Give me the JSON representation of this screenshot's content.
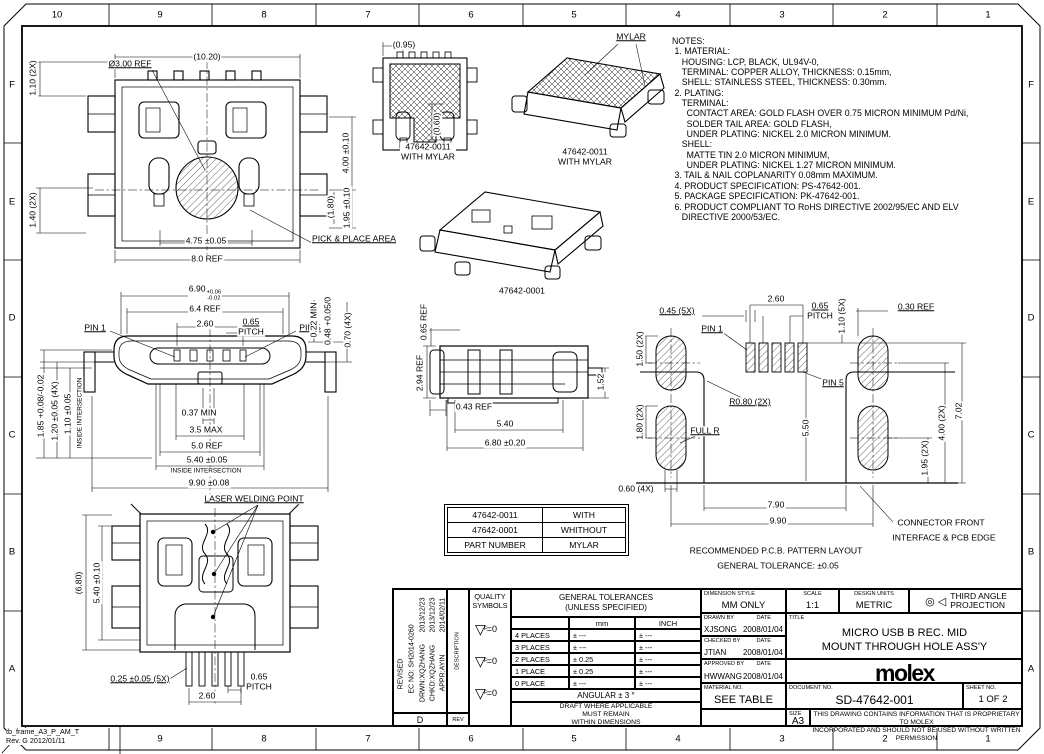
{
  "frame": {
    "cols": [
      "10",
      "9",
      "8",
      "7",
      "6",
      "5",
      "4",
      "3",
      "2",
      "1"
    ],
    "rows": [
      "F",
      "E",
      "D",
      "C",
      "B",
      "A"
    ],
    "stamp": [
      "tb_frame_A3_P_AM_T",
      "Rev. G 2012/01/11"
    ]
  },
  "notes": {
    "lines": [
      "NOTES:",
      " 1. MATERIAL:",
      "    HOUSING: LCP, BLACK, UL94V-0,",
      "    TERMINAL: COPPER ALLOY, THICKNESS: 0.15mm,",
      "    SHELL: STAINLESS STEEL, THICKNESS: 0.30mm.",
      " 2. PLATING:",
      "    TERMINAL:",
      "      CONTACT AREA: GOLD FLASH OVER 0.75 MICRON MINIMUM Pd/Ni,",
      "      SOLDER TAIL AREA: GOLD FLASH,",
      "      UNDER PLATING: NICKEL 2.0 MICRON MINIMUM.",
      "    SHELL:",
      "      MATTE TIN 2.0 MICRON MINIMUM,",
      "      UNDER PLATING: NICKEL 1.27 MICRON MINIMUM.",
      " 3. TAIL & NAIL COPLANARITY 0.08mm MAXIMUM.",
      " 4. PRODUCT SPECIFICATION: PS-47642-001.",
      " 5. PACKAGE SPECIFICATION: PK-47642-001.",
      " 6. PRODUCT COMPLIANT TO RoHS DIRECTIVE 2002/95/EC AND ELV",
      "    DIRECTIVE 2000/53/EC."
    ]
  },
  "views": {
    "top": {
      "d1020": "(10.20)",
      "dia": "Ø3.00 REF",
      "d110": "1.10 (2X)",
      "d140": "1.40 (2X)",
      "d400": "4.00 ±0.10",
      "d180": "(1.80)",
      "d195": "1.95 ±0.10",
      "d475": "4.75 ±0.05",
      "d80": "8.0 REF",
      "pick": "PICK & PLACE AREA"
    },
    "mylar_front": {
      "d095": "(0.95)",
      "d060": "(0.60)",
      "caption": [
        "47642-0011",
        "WITH MYLAR"
      ]
    },
    "iso_mylar": {
      "label": "MYLAR",
      "caption": [
        "47642-0011",
        "WITH MYLAR"
      ]
    },
    "iso_plain": {
      "caption": "47642-0001"
    },
    "front": {
      "d690": {
        "v": "6.90",
        "up": "+0.06",
        "dn": "-0.02"
      },
      "d64": "6.4 REF",
      "d260": "2.60",
      "d065": "0.65",
      "pitch": "PITCH",
      "pin1": "PIN 1",
      "pin5": "PIN 5",
      "d022": "0.22 MIN",
      "d048": "0.48 +0.05/0",
      "d070": "0.70 (4X)",
      "d037": "0.37 MIN",
      "d35": "3.5 MAX",
      "d50": "5.0 REF",
      "d540": "5.40 ±0.05",
      "inside1": "INSIDE INTERSECTION",
      "d990": "9.90 ±0.08",
      "d185": "1.85 +0.08/-0.02",
      "d120": "1.20 ±0.05 (4X)",
      "d110": "1.10 ±0.05",
      "inside2": "INSIDE INTERSECTION"
    },
    "side": {
      "d065": "0.65 REF",
      "d294": "2.94 REF",
      "d043": "0.43 REF",
      "d540": "5.40",
      "d680": "6.80 ±0.20",
      "d152": "1.52"
    },
    "pcb": {
      "d260": "2.60",
      "d045": "0.45 (5X)",
      "d065": "0.65",
      "pitch": "PITCH",
      "d110": "1.10 (5X)",
      "d030": "0.30 REF",
      "d150": "1.50 (2X)",
      "d180": "1.80 (2X)",
      "pin1": "PIN 1",
      "pin5": "PIN 5",
      "r080": "R0.80 (2X)",
      "fullr": "FULL R",
      "d550": "5.50",
      "d060": "0.60 (4X)",
      "d790": "7.90",
      "d990": "9.90",
      "d195": "1.95 (2X)",
      "d400": "4.00 (2X)",
      "d702": "7.02",
      "cf1": "CONNECTOR FRONT",
      "cf2": "INTERFACE & PCB EDGE",
      "t1": "RECOMMENDED P.C.B. PATTERN LAYOUT",
      "t2": "GENERAL TOLERANCE: ±0.05"
    },
    "bottom": {
      "laser": "LASER WELDING POINT",
      "d680": "(6.80)",
      "d540": "5.40 ±0.10",
      "d025": "0.25 ±0.05 (5X)",
      "d065": "0.65",
      "pitch": "PITCH",
      "d260": "2.60"
    }
  },
  "part_table": {
    "rows": [
      [
        "47642-0011",
        "WITH"
      ],
      [
        "47642-0001",
        "WHITHOUT"
      ],
      [
        "PART NUMBER",
        "MYLAR"
      ]
    ]
  },
  "title_block": {
    "revision": {
      "revised": "REVISED",
      "ec": "EC NO: SH2014-0260",
      "drwn": "DRWN:XQZHANG",
      "chkd": "CHKD:XQZHANG",
      "appr": "APPR:AYIN",
      "dates": [
        "2013/12/23",
        "2013/12/23",
        "2014/02/11"
      ],
      "rev_value": "D",
      "rev_label": "REV",
      "description_label": "DESCRIPTION"
    },
    "quality": {
      "header": [
        "QUALITY",
        "SYMBOLS"
      ],
      "symbols": [
        {
          "letter": "F",
          "value": "=0"
        },
        {
          "letter": "F",
          "value": "=0"
        },
        {
          "letter": "F",
          "value": "=0"
        }
      ]
    },
    "tolerances": {
      "title": [
        "GENERAL TOLERANCES",
        "(UNLESS SPECIFIED)"
      ],
      "col_mm": "mm",
      "col_inch": "INCH",
      "rows": [
        [
          "4 PLACES",
          "± ---",
          "± ---"
        ],
        [
          "3 PLACES",
          "± ---",
          "± ---"
        ],
        [
          "2 PLACES",
          "± 0.25",
          "± ---"
        ],
        [
          "1 PLACE",
          "± 0.25",
          "± ---"
        ],
        [
          "0 PLACE",
          "± ---",
          "± ---"
        ]
      ],
      "angular": "ANGULAR ± 3 °",
      "draft": [
        "DRAFT WHERE APPLICABLE",
        "MUST REMAIN",
        "WITHIN DIMENSIONS"
      ]
    },
    "dimension_style": {
      "label": "DIMENSION STYLE",
      "value": "MM ONLY"
    },
    "scale": {
      "label": "SCALE",
      "value": "1:1"
    },
    "design_units": {
      "label": "DESIGN UNITS",
      "value": "METRIC"
    },
    "projection": {
      "symbols": "◎ ◁",
      "label": [
        "THIRD ANGLE",
        "PROJECTION"
      ]
    },
    "drawn": {
      "label": "DRAWN BY",
      "date_label": "DATE",
      "name": "XJSONG",
      "date": "2008/01/04"
    },
    "checked": {
      "label": "CHECKED BY",
      "date_label": "DATE",
      "name": "JTIAN",
      "date": "2008/01/04"
    },
    "approved": {
      "label": "APPROVED BY",
      "date_label": "DATE",
      "name": "HWWANG",
      "date": "2008/01/04"
    },
    "title": {
      "label": "TITLE",
      "lines": [
        "MICRO USB B REC. MID",
        "MOUNT THROUGH HOLE ASS'Y"
      ]
    },
    "logo": "molex",
    "material": {
      "label": "MATERIAL NO.",
      "value": "SEE TABLE"
    },
    "document": {
      "label": "DOCUMENT NO.",
      "value": "SD-47642-001"
    },
    "sheet": {
      "label": "SHEET NO.",
      "value": "1 OF 2"
    },
    "size": {
      "label": "SIZE",
      "value": "A3"
    },
    "disclaimer": [
      "THIS DRAWING CONTAINS INFORMATION THAT IS PROPRIETARY TO MOLEX",
      "INCORPORATED AND SHOULD NOT BE USED WITHOUT WRITTEN PERMISSION"
    ]
  }
}
